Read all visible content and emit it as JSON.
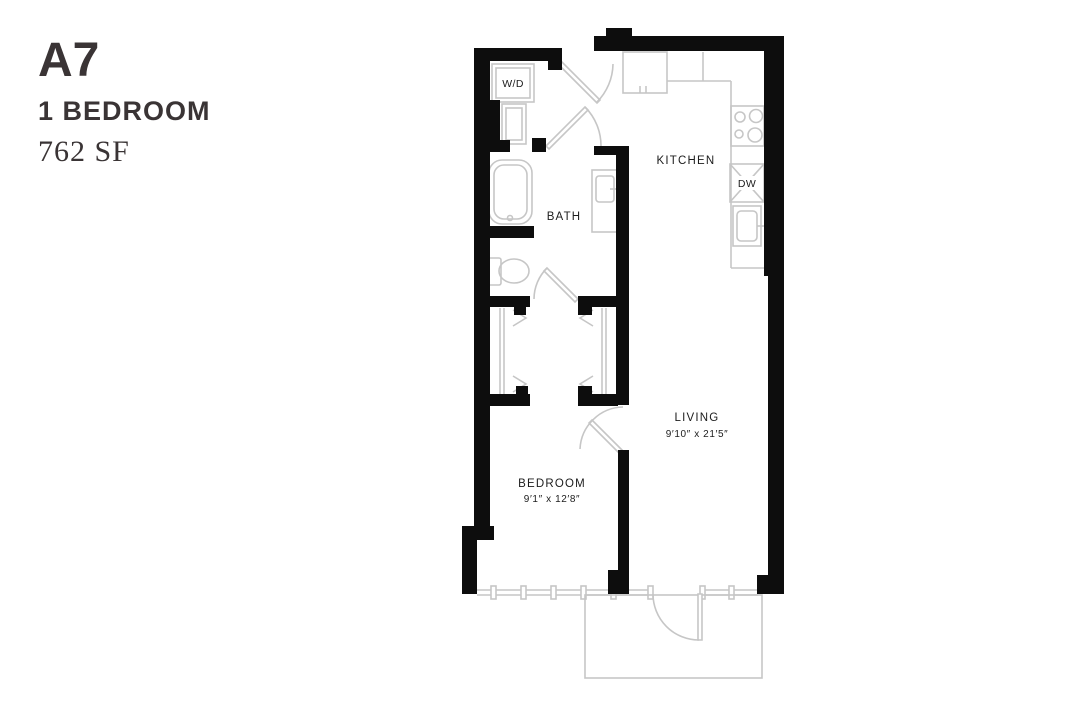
{
  "header": {
    "plan_code": "A7",
    "plan_type": "1 BEDROOM",
    "area": "762 SF"
  },
  "floorplan": {
    "rooms": {
      "kitchen": {
        "label": "KITCHEN"
      },
      "bath": {
        "label": "BATH"
      },
      "living": {
        "label": "LIVING",
        "dimensions": "9′10″ x 21′5″"
      },
      "bedroom": {
        "label": "BEDROOM",
        "dimensions": "9′1″ x 12′8″"
      }
    },
    "appliances": {
      "washer_dryer": "W/D",
      "dishwasher": "DW"
    },
    "colors": {
      "walls": "#0d0d0d",
      "fixtures": "#c6c6c6",
      "labels": "#1c1c1c",
      "title_text": "#3a3435",
      "background": "#ffffff"
    }
  }
}
